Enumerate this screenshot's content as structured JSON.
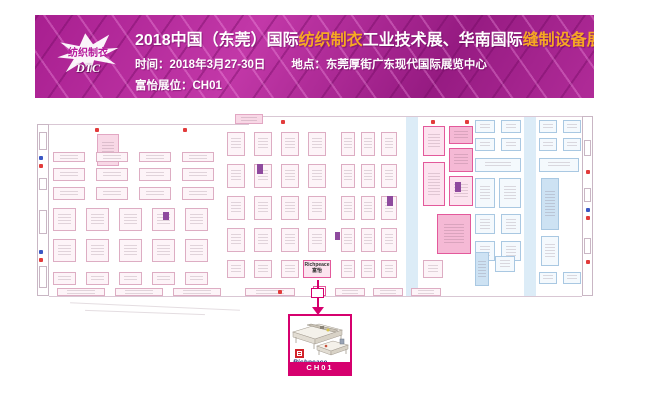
{
  "banner": {
    "logo": {
      "line1": "纺织制衣",
      "line2": "DTC"
    },
    "title_parts": [
      {
        "text": "2018中国（东莞）国际",
        "color": "#ffffff"
      },
      {
        "text": "纺织制衣",
        "color": "#f7a823"
      },
      {
        "text": "工业技术展、华南国际",
        "color": "#ffffff"
      },
      {
        "text": "缝制设备展",
        "color": "#f7a823"
      }
    ],
    "time_text": "时间：2018年3月27-30日",
    "place_text": "地点：东莞厚街广东现代国际展览中心",
    "booth_text": "富怡展位：CH01",
    "colors": {
      "bg": "#a81f90",
      "accent": "#f7a823",
      "highlight": "#d6006e"
    }
  },
  "map": {
    "booth_label": {
      "line1": "Richpeace",
      "line2": "富怡"
    },
    "elements": [
      {
        "t": "r",
        "x": 2,
        "y": 12,
        "w": 12,
        "h": 172,
        "s": "wall"
      },
      {
        "t": "r",
        "x": 4,
        "y": 20,
        "w": 8,
        "h": 18,
        "s": "wall"
      },
      {
        "t": "r",
        "x": 4,
        "y": 66,
        "w": 8,
        "h": 12,
        "s": "wall"
      },
      {
        "t": "r",
        "x": 4,
        "y": 98,
        "w": 8,
        "h": 24,
        "s": "wall"
      },
      {
        "t": "r",
        "x": 4,
        "y": 154,
        "w": 8,
        "h": 22,
        "s": "wall"
      },
      {
        "t": "r",
        "x": 547,
        "y": 4,
        "w": 11,
        "h": 180,
        "s": "wall"
      },
      {
        "t": "r",
        "x": 549,
        "y": 28,
        "w": 7,
        "h": 16,
        "s": "wall"
      },
      {
        "t": "r",
        "x": 549,
        "y": 76,
        "w": 7,
        "h": 14,
        "s": "wall"
      },
      {
        "t": "r",
        "x": 549,
        "y": 126,
        "w": 7,
        "h": 16,
        "s": "wall"
      },
      {
        "t": "r",
        "x": 14,
        "y": 12,
        "w": 200,
        "h": 1,
        "s": "line"
      },
      {
        "t": "r",
        "x": 214,
        "y": 4,
        "w": 333,
        "h": 1,
        "s": "line"
      },
      {
        "t": "r",
        "x": 14,
        "y": 184,
        "w": 533,
        "h": 1,
        "s": "line"
      },
      {
        "t": "r",
        "x": 371,
        "y": 5,
        "w": 12,
        "h": 179,
        "s": "ai"
      },
      {
        "t": "r",
        "x": 489,
        "y": 5,
        "w": 12,
        "h": 179,
        "s": "ai"
      },
      {
        "t": "r",
        "x": 200,
        "y": 2,
        "w": 28,
        "h": 10,
        "s": "pf"
      },
      {
        "t": "r",
        "x": 62,
        "y": 22,
        "w": 22,
        "h": 32,
        "s": "pf"
      },
      {
        "t": "g",
        "x": 18,
        "y": 40,
        "cols": 4,
        "rows": 1,
        "cw": 32,
        "ch": 10,
        "gx": 11,
        "gy": 0,
        "s": "p"
      },
      {
        "t": "g",
        "x": 18,
        "y": 56,
        "cols": 4,
        "rows": 2,
        "cw": 32,
        "ch": 13,
        "gx": 11,
        "gy": 6,
        "s": "p"
      },
      {
        "t": "g",
        "x": 18,
        "y": 96,
        "cols": 5,
        "rows": 2,
        "cw": 23,
        "ch": 23,
        "gx": 10,
        "gy": 8,
        "s": "p"
      },
      {
        "t": "g",
        "x": 18,
        "y": 160,
        "cols": 5,
        "rows": 1,
        "cw": 23,
        "ch": 13,
        "gx": 10,
        "gy": 0,
        "s": "p"
      },
      {
        "t": "g",
        "x": 192,
        "y": 20,
        "cols": 4,
        "rows": 4,
        "cw": 18,
        "ch": 24,
        "gx": 9,
        "gy": 8,
        "s": "p"
      },
      {
        "t": "g",
        "x": 306,
        "y": 20,
        "cols": 2,
        "rows": 4,
        "cw": 14,
        "ch": 24,
        "gx": 6,
        "gy": 8,
        "s": "p"
      },
      {
        "t": "g",
        "x": 346,
        "y": 20,
        "cols": 1,
        "rows": 4,
        "cw": 16,
        "ch": 24,
        "gx": 0,
        "gy": 8,
        "s": "p"
      },
      {
        "t": "g",
        "x": 192,
        "y": 148,
        "cols": 3,
        "rows": 1,
        "cw": 18,
        "ch": 18,
        "gx": 9,
        "gy": 0,
        "s": "p"
      },
      {
        "t": "g",
        "x": 306,
        "y": 148,
        "cols": 2,
        "rows": 1,
        "cw": 14,
        "ch": 18,
        "gx": 6,
        "gy": 0,
        "s": "p"
      },
      {
        "t": "r",
        "x": 346,
        "y": 148,
        "w": 16,
        "h": 18,
        "s": "p"
      },
      {
        "t": "r",
        "x": 388,
        "y": 14,
        "w": 22,
        "h": 30,
        "s": "m"
      },
      {
        "t": "r",
        "x": 388,
        "y": 50,
        "w": 22,
        "h": 44,
        "s": "m"
      },
      {
        "t": "r",
        "x": 414,
        "y": 14,
        "w": 24,
        "h": 18,
        "s": "mf"
      },
      {
        "t": "r",
        "x": 414,
        "y": 36,
        "w": 24,
        "h": 24,
        "s": "mf"
      },
      {
        "t": "r",
        "x": 414,
        "y": 64,
        "w": 24,
        "h": 30,
        "s": "m"
      },
      {
        "t": "r",
        "x": 402,
        "y": 102,
        "w": 34,
        "h": 40,
        "s": "mf"
      },
      {
        "t": "r",
        "x": 388,
        "y": 148,
        "w": 20,
        "h": 18,
        "s": "p"
      },
      {
        "t": "g",
        "x": 440,
        "y": 8,
        "cols": 2,
        "rows": 2,
        "cw": 20,
        "ch": 13,
        "gx": 6,
        "gy": 5,
        "s": "b"
      },
      {
        "t": "g",
        "x": 504,
        "y": 8,
        "cols": 2,
        "rows": 2,
        "cw": 18,
        "ch": 13,
        "gx": 6,
        "gy": 5,
        "s": "b"
      },
      {
        "t": "r",
        "x": 440,
        "y": 46,
        "w": 46,
        "h": 14,
        "s": "b"
      },
      {
        "t": "r",
        "x": 504,
        "y": 46,
        "w": 40,
        "h": 14,
        "s": "b"
      },
      {
        "t": "r",
        "x": 440,
        "y": 66,
        "w": 20,
        "h": 30,
        "s": "b"
      },
      {
        "t": "r",
        "x": 464,
        "y": 66,
        "w": 22,
        "h": 30,
        "s": "b"
      },
      {
        "t": "r",
        "x": 506,
        "y": 66,
        "w": 18,
        "h": 52,
        "s": "bf"
      },
      {
        "t": "g",
        "x": 440,
        "y": 102,
        "cols": 2,
        "rows": 2,
        "cw": 20,
        "ch": 20,
        "gx": 6,
        "gy": 7,
        "s": "b"
      },
      {
        "t": "r",
        "x": 506,
        "y": 124,
        "w": 18,
        "h": 30,
        "s": "b"
      },
      {
        "t": "r",
        "x": 440,
        "y": 140,
        "w": 14,
        "h": 34,
        "s": "bf"
      },
      {
        "t": "r",
        "x": 460,
        "y": 144,
        "w": 20,
        "h": 16,
        "s": "b"
      },
      {
        "t": "g",
        "x": 504,
        "y": 160,
        "cols": 2,
        "rows": 1,
        "cw": 18,
        "ch": 12,
        "gx": 6,
        "gy": 0,
        "s": "b"
      },
      {
        "t": "r",
        "x": 222,
        "y": 52,
        "w": 6,
        "h": 10,
        "s": "v"
      },
      {
        "t": "r",
        "x": 352,
        "y": 84,
        "w": 6,
        "h": 10,
        "s": "v"
      },
      {
        "t": "r",
        "x": 420,
        "y": 70,
        "w": 6,
        "h": 10,
        "s": "v"
      },
      {
        "t": "r",
        "x": 300,
        "y": 120,
        "w": 5,
        "h": 8,
        "s": "v"
      },
      {
        "t": "r",
        "x": 128,
        "y": 100,
        "w": 6,
        "h": 8,
        "s": "v"
      },
      {
        "t": "g",
        "x": 22,
        "y": 176,
        "cols": 3,
        "rows": 1,
        "cw": 48,
        "ch": 8,
        "gx": 10,
        "gy": 0,
        "s": "p"
      },
      {
        "t": "r",
        "x": 210,
        "y": 176,
        "w": 50,
        "h": 8,
        "s": "p"
      },
      {
        "t": "g",
        "x": 300,
        "y": 176,
        "cols": 3,
        "rows": 1,
        "cw": 30,
        "ch": 8,
        "gx": 8,
        "gy": 0,
        "s": "p"
      },
      {
        "t": "lab",
        "x": 268,
        "y": 148,
        "w": 28,
        "h": 18,
        "s": "m"
      },
      {
        "t": "r",
        "x": 278,
        "y": 174,
        "w": 13,
        "h": 10,
        "s": "mbox"
      },
      {
        "t": "d",
        "x": 4,
        "y": 44,
        "s": "bd"
      },
      {
        "t": "d",
        "x": 4,
        "y": 52,
        "s": "rd"
      },
      {
        "t": "d",
        "x": 4,
        "y": 138,
        "s": "bd"
      },
      {
        "t": "d",
        "x": 4,
        "y": 146,
        "s": "rd"
      },
      {
        "t": "d",
        "x": 551,
        "y": 58,
        "s": "rd"
      },
      {
        "t": "d",
        "x": 551,
        "y": 96,
        "s": "bd"
      },
      {
        "t": "d",
        "x": 551,
        "y": 104,
        "s": "rd"
      },
      {
        "t": "d",
        "x": 551,
        "y": 148,
        "s": "rd"
      },
      {
        "t": "d",
        "x": 60,
        "y": 16,
        "s": "rd"
      },
      {
        "t": "d",
        "x": 148,
        "y": 16,
        "s": "rd"
      },
      {
        "t": "d",
        "x": 246,
        "y": 8,
        "s": "rd"
      },
      {
        "t": "d",
        "x": 396,
        "y": 8,
        "s": "rd"
      },
      {
        "t": "d",
        "x": 430,
        "y": 8,
        "s": "rd"
      },
      {
        "t": "d",
        "x": 243,
        "y": 178,
        "s": "rd"
      }
    ]
  },
  "callout": {
    "brand": "Richpeace",
    "booth": "CH01",
    "border_color": "#d6006e"
  }
}
